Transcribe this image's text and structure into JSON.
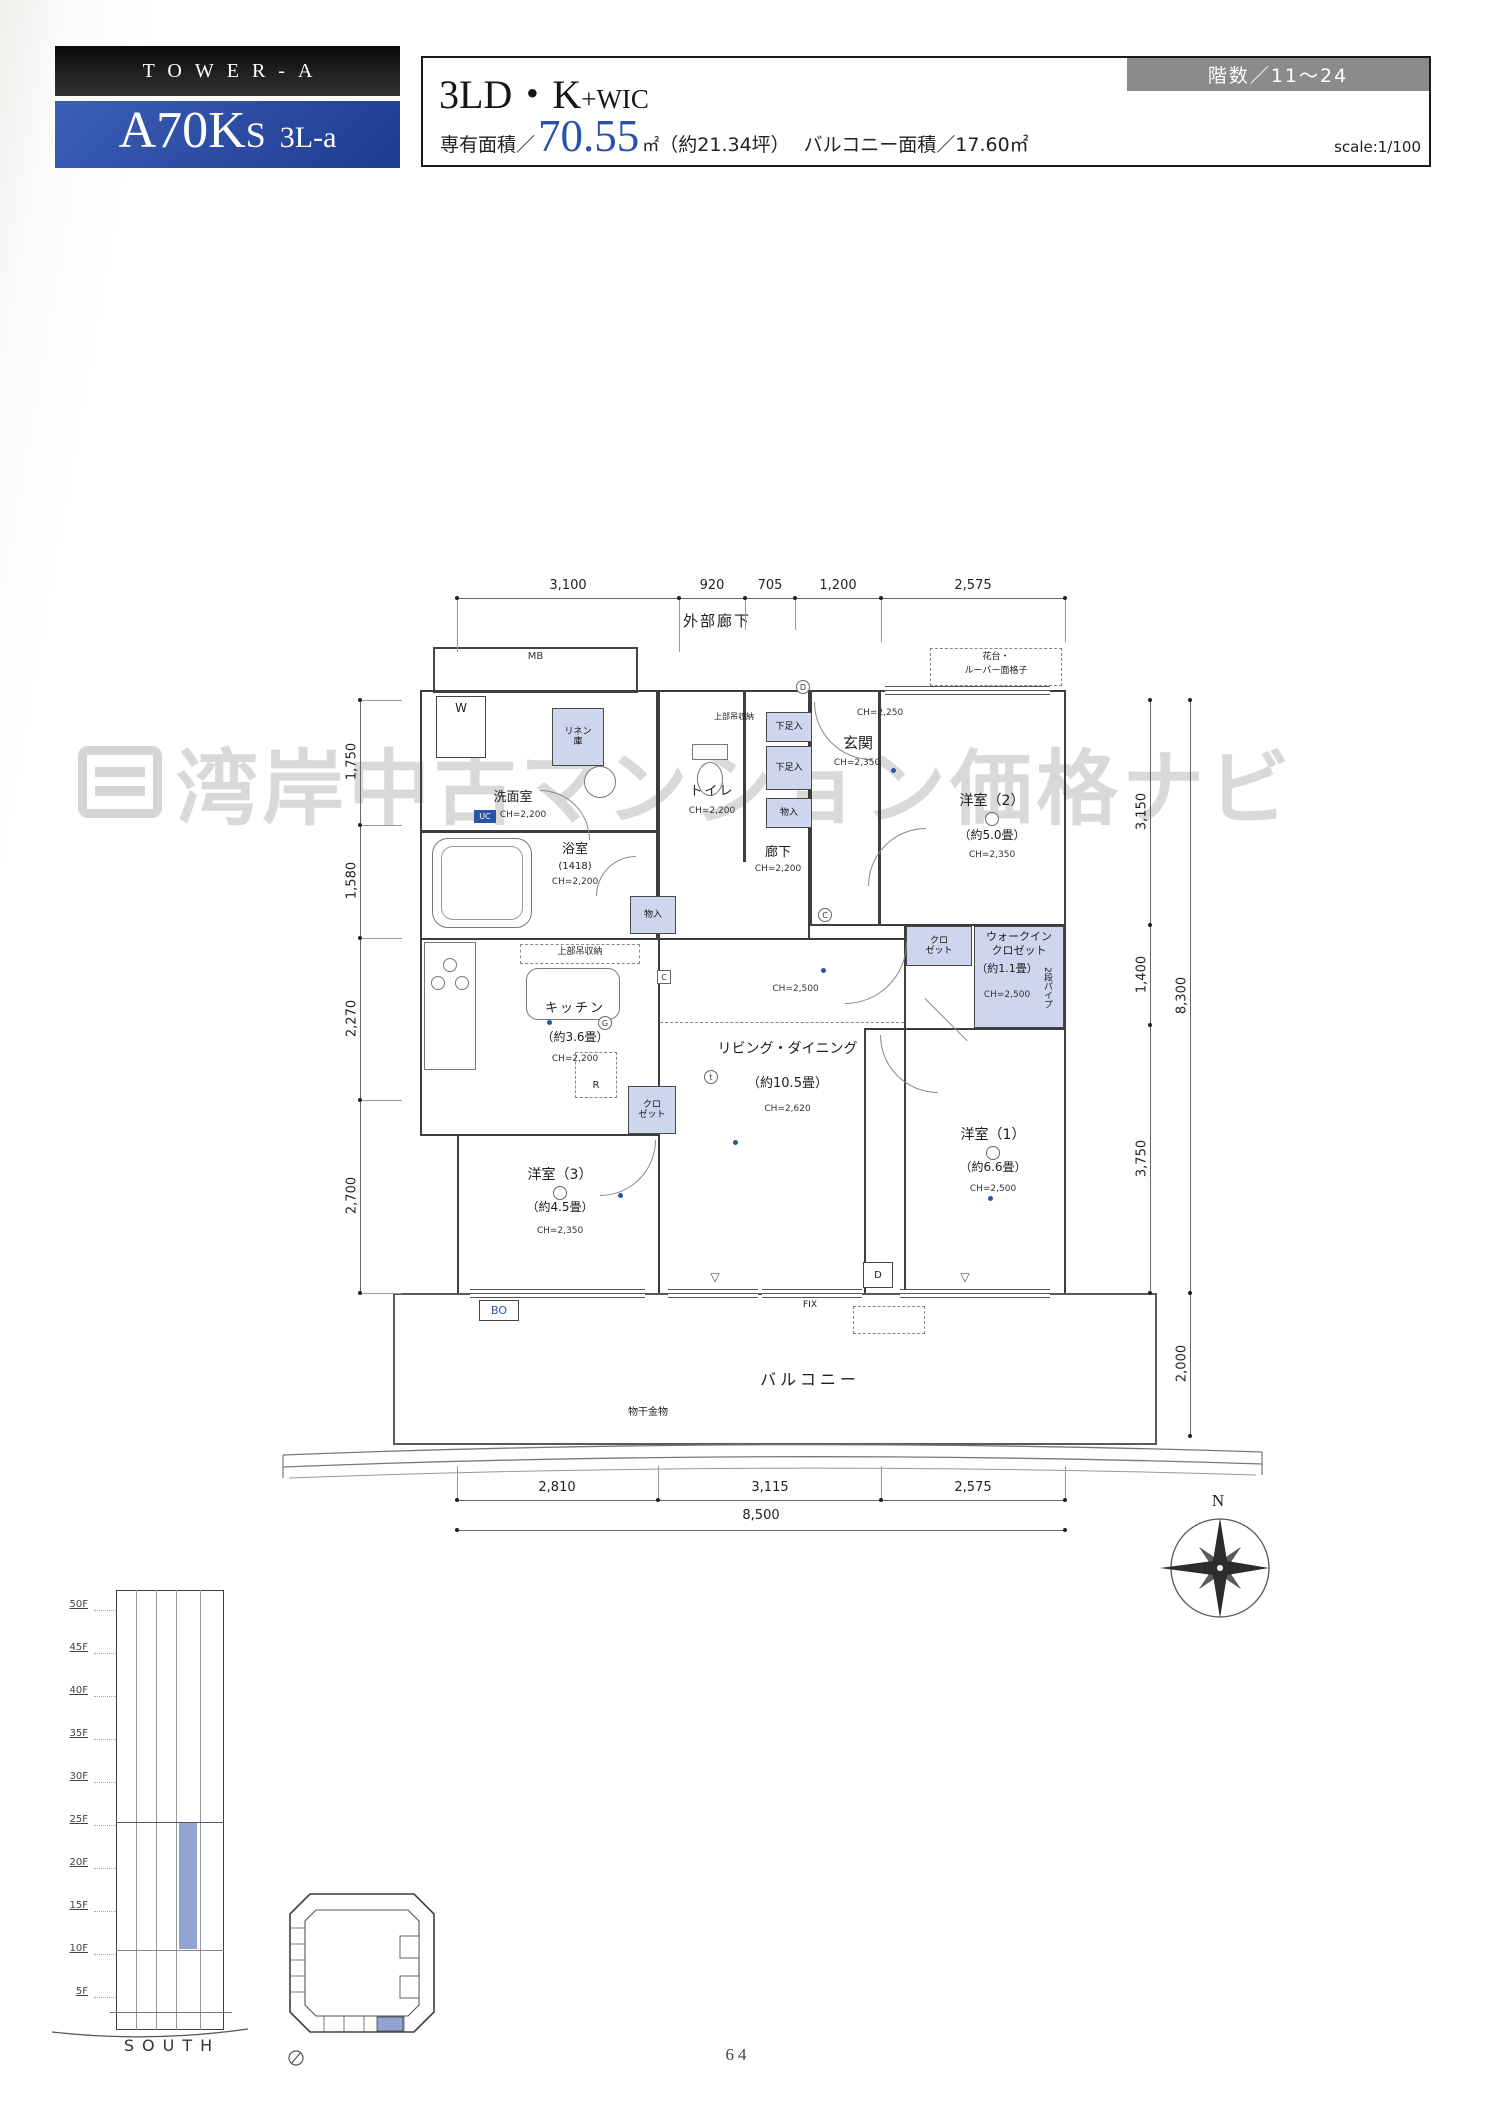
{
  "header": {
    "tower": "TOWER-A",
    "unit_main": "A70K",
    "unit_s": "S",
    "unit_type": "3L-a",
    "plan_main": "3LD・K",
    "plan_wic": "+WIC",
    "area_label": "専有面積／",
    "area_value": "70.55",
    "area_unit": "㎡",
    "area_tsubo": "（約21.34坪）",
    "balcony_area": "バルコニー面積／17.60㎡",
    "floors_badge": "階数／11〜24",
    "scale": "scale:1/100"
  },
  "plan": {
    "exterior_corridor": "外部廊下",
    "mb": "MB",
    "hanadai_line1": "花台・",
    "hanadai_line2": "ルーバー面格子",
    "rooms": {
      "washroom": {
        "name": "洗面室",
        "ch": "CH=2,200"
      },
      "bath": {
        "name": "浴室",
        "size": "(1418)",
        "ch": "CH=2,200"
      },
      "toilet": {
        "name": "トイレ",
        "ch": "CH=2,200"
      },
      "entrance": {
        "name": "玄関",
        "ch": "CH=2,350",
        "ch_hall": "CH=2,250"
      },
      "hall": {
        "name": "廊下",
        "ch": "CH=2,200"
      },
      "bedroom2": {
        "name": "洋室（2）",
        "size": "（約5.0畳）",
        "ch": "CH=2,350"
      },
      "wic": {
        "name_line1": "ウォークイン",
        "name_line2": "クロゼット",
        "size": "（約1.1畳）",
        "ch": "CH=2,500",
        "pipe": "2段パイプ"
      },
      "kitchen": {
        "name": "キッチン",
        "size": "（約3.6畳）",
        "ch": "CH=2,200"
      },
      "living": {
        "name": "リビング・ダイニング",
        "size": "（約10.5畳）",
        "ch": "CH=2,620",
        "ch_upper": "CH=2,500"
      },
      "bedroom3": {
        "name": "洋室（3）",
        "size": "（約4.5畳）",
        "ch": "CH=2,350"
      },
      "bedroom1": {
        "name": "洋室（1）",
        "size": "（約6.6畳）",
        "ch": "CH=2,500"
      },
      "balcony": {
        "name": "バルコニー"
      }
    },
    "fixtures": {
      "linen_line1": "リネン",
      "linen_line2": "庫",
      "washer": "W",
      "uc": "UC",
      "shoes_upper": "下足入",
      "shoes_lower": "下足入",
      "storage_hall": "物入",
      "storage_inner": "物入",
      "upper_cabinet_toilet": "上部吊収納",
      "upper_cabinet_kitchen": "上部吊収納",
      "closet_line1": "クロ",
      "closet_line2": "ゼット",
      "fridge": "R",
      "g_mark": "G",
      "c_mark": "C",
      "c_mark2": "C",
      "d_mark": "D",
      "t_mark": "t",
      "d_box": "D",
      "bo": "BO",
      "fix": "FIX",
      "monohoshi": "物干金物",
      "partition": "▽"
    },
    "dims": {
      "top": [
        "3,100",
        "920",
        "705",
        "1,200",
        "2,575"
      ],
      "left": [
        "1,750",
        "1,580",
        "2,270",
        "2,700"
      ],
      "right_inner": [
        "3,150",
        "1,400",
        "3,750"
      ],
      "right_outer": [
        "8,300",
        "2,000"
      ],
      "bottom": [
        "2,810",
        "3,115",
        "2,575"
      ],
      "bottom_total": "8,500"
    },
    "compass_n": "N"
  },
  "watermark": "湾岸中古マンション価格ナビ",
  "elevation": {
    "floors": [
      "50F",
      "45F",
      "40F",
      "35F",
      "30F",
      "25F",
      "20F",
      "15F",
      "10F",
      "5F"
    ],
    "direction": "SOUTH"
  },
  "page_number": "64"
}
